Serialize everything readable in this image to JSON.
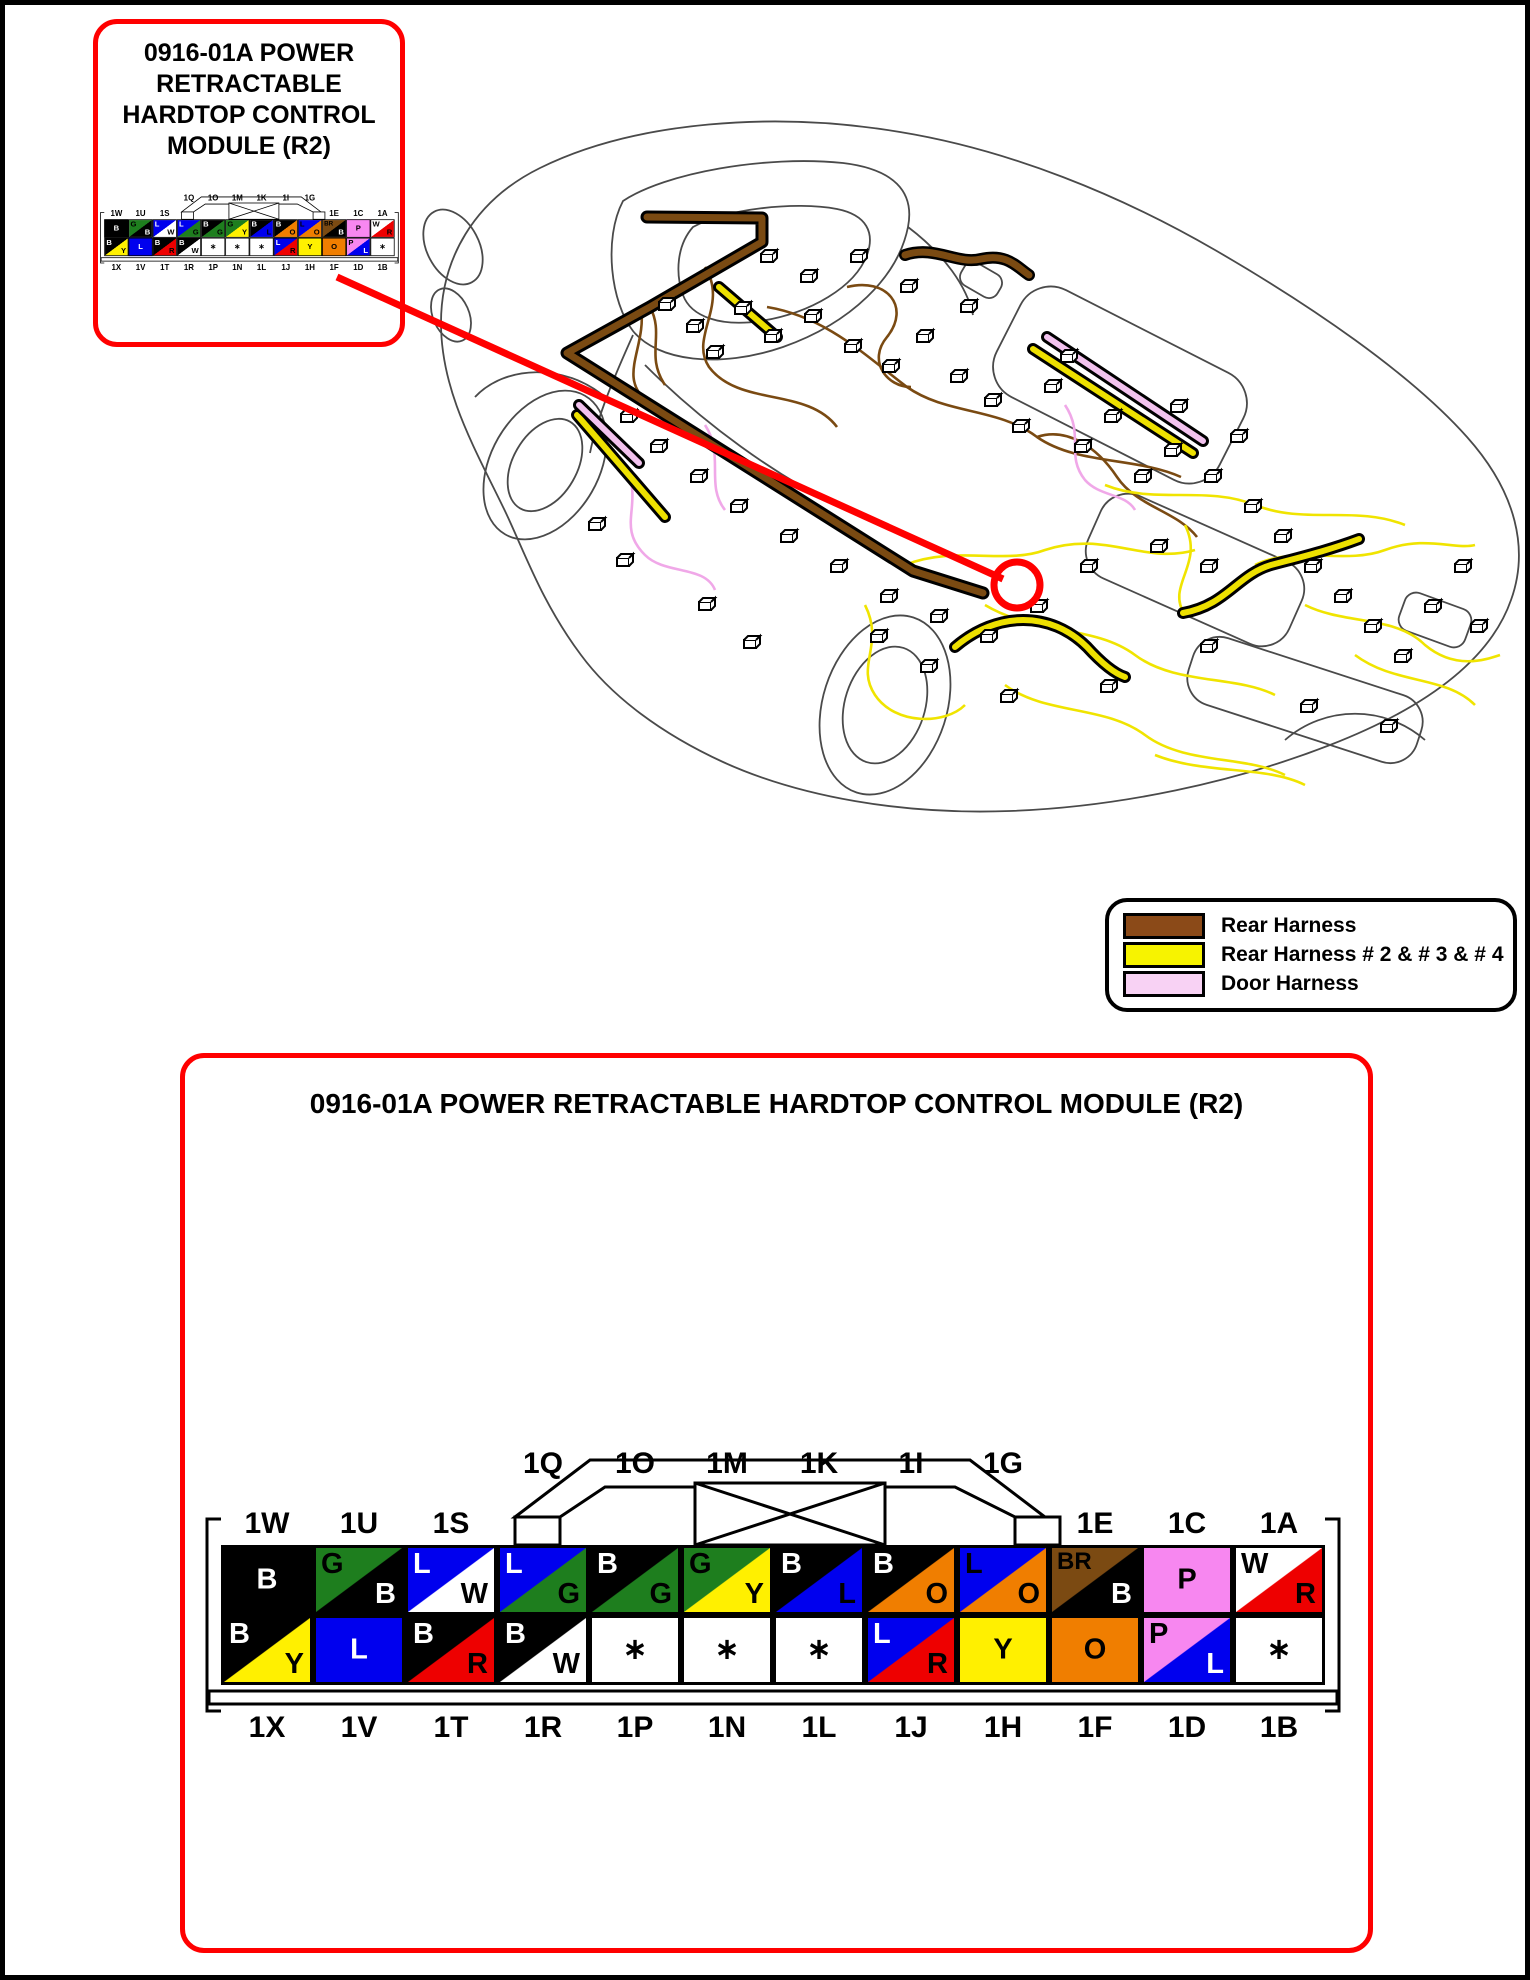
{
  "accent_red": "#FF0000",
  "callout": {
    "title_lines": [
      "0916-01A POWER",
      "RETRACTABLE",
      "HARDTOP CONTROL",
      "MODULE (R2)"
    ]
  },
  "main_panel": {
    "title": "0916-01A POWER RETRACTABLE HARDTOP CONTROL MODULE (R2)"
  },
  "legend": {
    "items": [
      {
        "label": "Rear Harness",
        "color": "#8B4A18"
      },
      {
        "label": "Rear Harness # 2 & # 3 & # 4",
        "color": "#F7F300"
      },
      {
        "label": "Door Harness",
        "color": "#F8D2F4"
      }
    ]
  },
  "wire_colors": {
    "rear_harness": "#7A4A12",
    "rear_harness_234": "#EDE000",
    "door_harness": "#F2C2EE",
    "thin_yellow": "#F0E400",
    "thin_pink": "#F0A8E8"
  },
  "connector": {
    "colors": {
      "black": "#000000",
      "white": "#FFFFFF",
      "green": "#1E7E1E",
      "blue": "#0000EE",
      "yellow": "#FFF000",
      "orange": "#F07E00",
      "red": "#EE0000",
      "pink": "#F787F0",
      "brown": "#7B4A12"
    },
    "top_bridge_labels": [
      "1Q",
      "1O",
      "1M",
      "1K",
      "1I",
      "1G"
    ],
    "top_labels": [
      {
        "col": 0,
        "text": "1W"
      },
      {
        "col": 1,
        "text": "1U"
      },
      {
        "col": 2,
        "text": "1S"
      },
      {
        "col": 9,
        "text": "1E"
      },
      {
        "col": 10,
        "text": "1C"
      },
      {
        "col": 11,
        "text": "1A"
      }
    ],
    "bottom_labels": [
      "1X",
      "1V",
      "1T",
      "1R",
      "1P",
      "1N",
      "1L",
      "1J",
      "1H",
      "1F",
      "1D",
      "1B"
    ],
    "row1": [
      {
        "c1": "black",
        "c2": null,
        "letters": [
          {
            "t": "B",
            "color": "#FFFFFF",
            "pos": "c"
          }
        ]
      },
      {
        "c1": "green",
        "c2": "black",
        "letters": [
          {
            "t": "G",
            "color": "#000000",
            "pos": "tl"
          },
          {
            "t": "B",
            "color": "#FFFFFF",
            "pos": "br"
          }
        ]
      },
      {
        "c1": "blue",
        "c2": "white",
        "letters": [
          {
            "t": "L",
            "color": "#FFFFFF",
            "pos": "tl"
          },
          {
            "t": "W",
            "color": "#000000",
            "pos": "br"
          }
        ]
      },
      {
        "c1": "blue",
        "c2": "green",
        "letters": [
          {
            "t": "L",
            "color": "#FFFFFF",
            "pos": "tl"
          },
          {
            "t": "G",
            "color": "#000000",
            "pos": "br"
          }
        ]
      },
      {
        "c1": "black",
        "c2": "green",
        "letters": [
          {
            "t": "B",
            "color": "#FFFFFF",
            "pos": "tl"
          },
          {
            "t": "G",
            "color": "#000000",
            "pos": "br"
          }
        ]
      },
      {
        "c1": "green",
        "c2": "yellow",
        "letters": [
          {
            "t": "G",
            "color": "#000000",
            "pos": "tl"
          },
          {
            "t": "Y",
            "color": "#000000",
            "pos": "br"
          }
        ]
      },
      {
        "c1": "black",
        "c2": "blue",
        "letters": [
          {
            "t": "B",
            "color": "#FFFFFF",
            "pos": "tl"
          },
          {
            "t": "L",
            "color": "#000000",
            "pos": "br"
          }
        ]
      },
      {
        "c1": "black",
        "c2": "orange",
        "letters": [
          {
            "t": "B",
            "color": "#FFFFFF",
            "pos": "tl"
          },
          {
            "t": "O",
            "color": "#000000",
            "pos": "br"
          }
        ]
      },
      {
        "c1": "blue",
        "c2": "orange",
        "letters": [
          {
            "t": "L",
            "color": "#000000",
            "pos": "tl"
          },
          {
            "t": "O",
            "color": "#000000",
            "pos": "br"
          }
        ]
      },
      {
        "c1": "brown",
        "c2": "black",
        "letters": [
          {
            "t": "BR",
            "color": "#000000",
            "pos": "tl"
          },
          {
            "t": "B",
            "color": "#FFFFFF",
            "pos": "br"
          }
        ]
      },
      {
        "c1": "pink",
        "c2": null,
        "letters": [
          {
            "t": "P",
            "color": "#000000",
            "pos": "c"
          }
        ]
      },
      {
        "c1": "white",
        "c2": "red",
        "letters": [
          {
            "t": "W",
            "color": "#000000",
            "pos": "tl"
          },
          {
            "t": "R",
            "color": "#000000",
            "pos": "br"
          }
        ]
      }
    ],
    "row2": [
      {
        "c1": "black",
        "c2": "yellow",
        "letters": [
          {
            "t": "B",
            "color": "#FFFFFF",
            "pos": "tl"
          },
          {
            "t": "Y",
            "color": "#000000",
            "pos": "br"
          }
        ]
      },
      {
        "c1": "blue",
        "c2": null,
        "letters": [
          {
            "t": "L",
            "color": "#FFFFFF",
            "pos": "c"
          }
        ]
      },
      {
        "c1": "black",
        "c2": "red",
        "letters": [
          {
            "t": "B",
            "color": "#FFFFFF",
            "pos": "tl"
          },
          {
            "t": "R",
            "color": "#000000",
            "pos": "br"
          }
        ]
      },
      {
        "c1": "black",
        "c2": "white",
        "letters": [
          {
            "t": "B",
            "color": "#FFFFFF",
            "pos": "tl"
          },
          {
            "t": "W",
            "color": "#000000",
            "pos": "br"
          }
        ]
      },
      {
        "c1": "white",
        "c2": null,
        "letters": [
          {
            "t": "∗",
            "color": "#000000",
            "pos": "c"
          }
        ]
      },
      {
        "c1": "white",
        "c2": null,
        "letters": [
          {
            "t": "∗",
            "color": "#000000",
            "pos": "c"
          }
        ]
      },
      {
        "c1": "white",
        "c2": null,
        "letters": [
          {
            "t": "∗",
            "color": "#000000",
            "pos": "c"
          }
        ]
      },
      {
        "c1": "blue",
        "c2": "red",
        "letters": [
          {
            "t": "L",
            "color": "#FFFFFF",
            "pos": "tl"
          },
          {
            "t": "R",
            "color": "#000000",
            "pos": "br"
          }
        ]
      },
      {
        "c1": "yellow",
        "c2": null,
        "letters": [
          {
            "t": "Y",
            "color": "#000000",
            "pos": "c"
          }
        ]
      },
      {
        "c1": "orange",
        "c2": null,
        "letters": [
          {
            "t": "O",
            "color": "#000000",
            "pos": "c"
          }
        ]
      },
      {
        "c1": "pink",
        "c2": "blue",
        "letters": [
          {
            "t": "P",
            "color": "#000000",
            "pos": "tl"
          },
          {
            "t": "L",
            "color": "#FFFFFF",
            "pos": "br"
          }
        ]
      },
      {
        "c1": "white",
        "c2": null,
        "letters": [
          {
            "t": "∗",
            "color": "#000000",
            "pos": "c"
          }
        ]
      }
    ]
  }
}
